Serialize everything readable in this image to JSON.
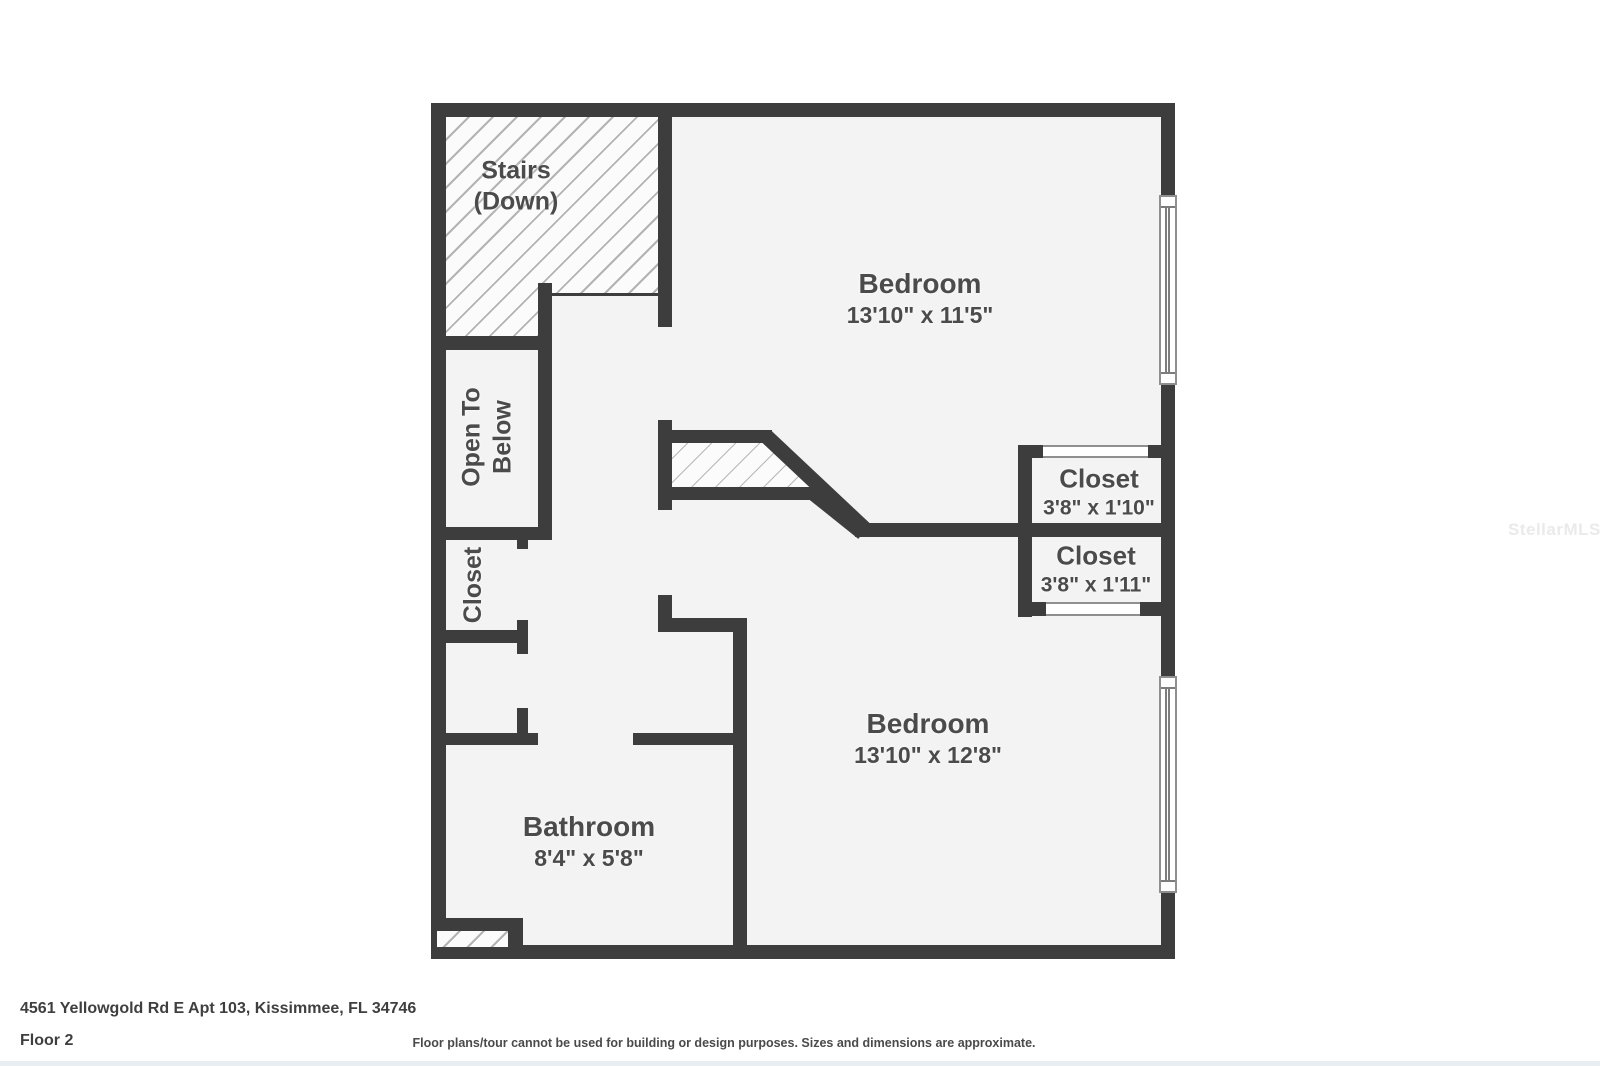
{
  "plan": {
    "rooms": {
      "stairs": {
        "line1": "Stairs",
        "line2": "(Down)"
      },
      "bedroom1": {
        "name": "Bedroom",
        "dims": "13'10\" x 11'5\""
      },
      "closet1": {
        "name": "Closet",
        "dims": "3'8\" x 1'10\""
      },
      "closet2": {
        "name": "Closet",
        "dims": "3'8\" x 1'11\""
      },
      "bedroom2": {
        "name": "Bedroom",
        "dims": "13'10\" x 12'8\""
      },
      "bathroom": {
        "name": "Bathroom",
        "dims": "8'4\" x 5'8\""
      },
      "open_to_below": {
        "line1": "Open To",
        "line2": "Below"
      },
      "closet_left": {
        "name": "Closet"
      }
    },
    "colors": {
      "wall": "#3d3d3d",
      "floor": "#f3f3f3",
      "hatch_line": "#b3b3b3",
      "label_text": "#4b4b4b"
    }
  },
  "footer": {
    "address": "4561 Yellowgold Rd E Apt 103, Kissimmee, FL 34746",
    "floor": "Floor 2",
    "disclaimer": "Floor plans/tour cannot be used for building or design purposes. Sizes and dimensions are approximate."
  },
  "watermark": "StellarMLS"
}
